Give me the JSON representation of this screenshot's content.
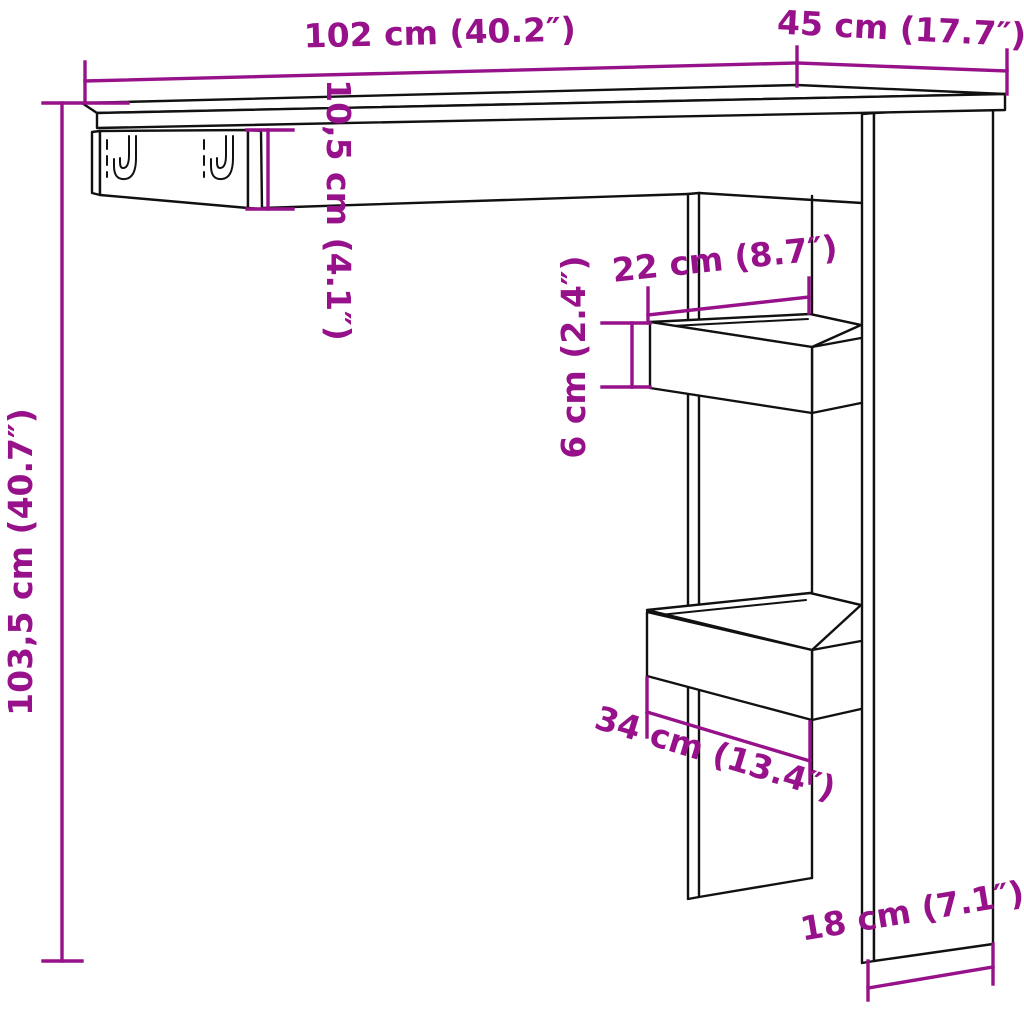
{
  "diagram": {
    "kind": "furniture-dimension-drawing",
    "labels": {
      "top_width": "102 cm (40.2″)",
      "top_depth": "45 cm (17.7″)",
      "overall_height": "103,5 cm (40.7″)",
      "rail_height": "10,5 cm (4.1″)",
      "upper_shelf_depth": "22 cm (8.7″)",
      "upper_shelf_rim_height": "6 cm (2.4″)",
      "lower_shelf_depth": "34 cm (13.4″)",
      "side_panel_bottom_depth": "18 cm (7.1″)"
    },
    "colors": {
      "dimension": "#97128A",
      "outline": "#111111",
      "background": "#FFFFFF"
    }
  }
}
